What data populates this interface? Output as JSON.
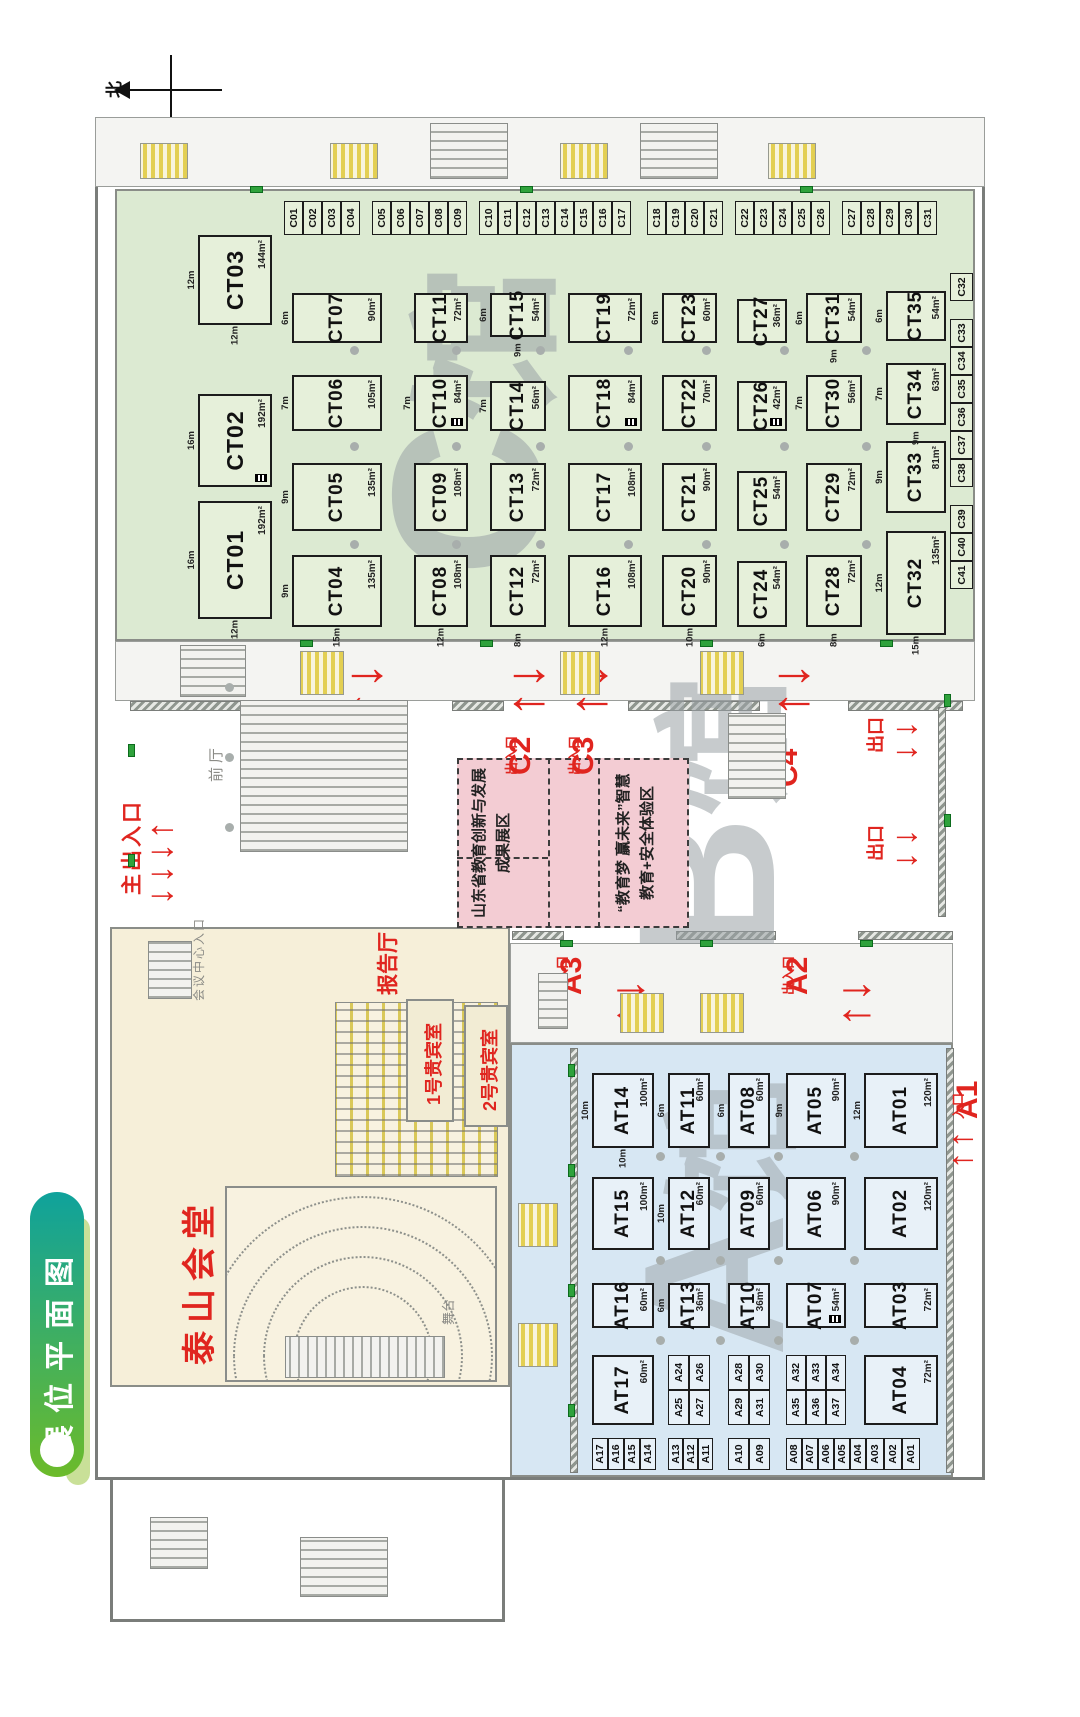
{
  "title": {
    "badge": "展位平面图"
  },
  "compass": {
    "north": "北"
  },
  "watermarks": {
    "c_hall": "C馆",
    "b_hall": "B馆",
    "a_hall": "A馆"
  },
  "entrances": {
    "main": {
      "label": "主出入口"
    },
    "c1": {
      "name": "C1",
      "label": "出入口"
    },
    "c2": {
      "name": "C2",
      "label": "出入口"
    },
    "c3": {
      "name": "C3",
      "label": "出入口"
    },
    "c4": {
      "name": "C4",
      "label": "出入口"
    },
    "a1": {
      "name": "A1",
      "label": "入口"
    },
    "a2": {
      "name": "A2",
      "label": "出入口"
    },
    "a3": {
      "name": "A3",
      "label": "出入口"
    },
    "exit": {
      "label": "出口"
    }
  },
  "zones": {
    "zone1": {
      "line1": "山东省教育创新与发展",
      "line2": "成果展区"
    },
    "zone2": {
      "line1": "“教育梦 赢未来”智慧",
      "line2": "教育+安全体验区"
    }
  },
  "rooms": {
    "taishan": "泰山会堂",
    "lecture": "报告厅",
    "vip1": "1号贵宾室",
    "vip2": "2号贵宾室",
    "front_hall": "前厅",
    "conf_entrance": "会议中心入口",
    "stage": "舞台"
  },
  "c_hall": {
    "top_row": [
      {
        "id": "CT01",
        "area": "192m²",
        "dim_top": "16m",
        "dim_left": "12m"
      },
      {
        "id": "CT02",
        "area": "192m²",
        "dim_top": "16m",
        "icon": true
      },
      {
        "id": "CT03",
        "area": "144m²",
        "dim_top": "12m",
        "dim_left": "12m"
      }
    ],
    "rows": [
      [
        {
          "id": "CT04",
          "area": "135m²",
          "dim_top": "9m",
          "dim_left": "15m"
        },
        {
          "id": "CT05",
          "area": "135m²",
          "dim_top": "9m"
        },
        {
          "id": "CT06",
          "area": "105m²",
          "dim_top": "7m"
        },
        {
          "id": "CT07",
          "area": "90m²",
          "dim_top": "6m"
        }
      ],
      [
        {
          "id": "CT08",
          "area": "108m²",
          "dim_left": "12m"
        },
        {
          "id": "CT09",
          "area": "108m²"
        },
        {
          "id": "CT10",
          "area": "84m²",
          "dim_top": "7m",
          "icon": true
        },
        {
          "id": "CT11",
          "area": "72m²"
        }
      ],
      [
        {
          "id": "CT12",
          "area": "72m²",
          "dim_left": "8m"
        },
        {
          "id": "CT13",
          "area": "72m²"
        },
        {
          "id": "CT14",
          "area": "56m²",
          "dim_top": "7m"
        },
        {
          "id": "CT15",
          "area": "54m²",
          "dim_top": "6m",
          "dim_left": "9m"
        }
      ],
      [
        {
          "id": "CT16",
          "area": "108m²",
          "dim_left": "12m"
        },
        {
          "id": "CT17",
          "area": "108m²"
        },
        {
          "id": "CT18",
          "area": "84m²",
          "icon": true
        },
        {
          "id": "CT19",
          "area": "72m²"
        }
      ],
      [
        {
          "id": "CT20",
          "area": "90m²",
          "dim_left": "10m"
        },
        {
          "id": "CT21",
          "area": "90m²"
        },
        {
          "id": "CT22",
          "area": "70m²"
        },
        {
          "id": "CT23",
          "area": "60m²",
          "dim_top": "6m"
        }
      ],
      [
        {
          "id": "CT24",
          "area": "54m²",
          "dim_left": "6m"
        },
        {
          "id": "CT25",
          "area": "54m²"
        },
        {
          "id": "CT26",
          "area": "42m²",
          "icon": true
        },
        {
          "id": "CT27",
          "area": "36m²"
        }
      ],
      [
        {
          "id": "CT28",
          "area": "72m²",
          "dim_left": "8m"
        },
        {
          "id": "CT29",
          "area": "72m²"
        },
        {
          "id": "CT30",
          "area": "56m²",
          "dim_top": "7m"
        },
        {
          "id": "CT31",
          "area": "54m²",
          "dim_top": "6m",
          "dim_left": "9m"
        }
      ],
      [
        {
          "id": "CT32",
          "area": "135m²",
          "dim_top": "12m",
          "dim_left": "15m"
        },
        {
          "id": "CT33",
          "area": "81m²",
          "dim_top": "9m"
        },
        {
          "id": "CT34",
          "area": "63m²",
          "dim_top": "7m",
          "dim_left": "9m"
        },
        {
          "id": "CT35",
          "area": "54m²",
          "dim_top": "6m"
        }
      ]
    ],
    "side_groups": [
      [
        "C01",
        "C02",
        "C03",
        "C04"
      ],
      [
        "C05",
        "C06",
        "C07",
        "C08",
        "C09"
      ],
      [
        "C10",
        "C11",
        "C12",
        "C13",
        "C14",
        "C15",
        "C16",
        "C17"
      ],
      [
        "C18",
        "C19",
        "C20",
        "C21"
      ],
      [
        "C22",
        "C23",
        "C24",
        "C25",
        "C26"
      ],
      [
        "C27",
        "C28",
        "C29",
        "C30",
        "C31"
      ]
    ],
    "bottom_groups": [
      [
        "C41",
        "C40",
        "C39"
      ],
      [
        "C38",
        "C37",
        "C36",
        "C35",
        "C34",
        "C33"
      ],
      [
        "C32"
      ]
    ]
  },
  "a_hall": {
    "columns": [
      [
        {
          "id": "AT14",
          "area": "100m²",
          "dim_top": "10m",
          "dim_left": "10m"
        },
        {
          "id": "AT11",
          "area": "60m²",
          "dim_top": "6m"
        },
        {
          "id": "AT08",
          "area": "60m²",
          "dim_top": "6m"
        },
        {
          "id": "AT05",
          "area": "90m²",
          "dim_top": "9m"
        },
        {
          "id": "AT01",
          "area": "120m²",
          "dim_top": "12m"
        }
      ],
      [
        {
          "id": "AT15",
          "area": "100m²"
        },
        {
          "id": "AT12",
          "area": "60m²",
          "dim_top": "10m"
        },
        {
          "id": "AT09",
          "area": "60m²"
        },
        {
          "id": "AT06",
          "area": "90m²"
        },
        {
          "id": "AT02",
          "area": "120m²"
        }
      ],
      [
        {
          "id": "AT16",
          "area": "60m²"
        },
        {
          "id": "AT13",
          "area": "36m²",
          "dim_top": "6m"
        },
        {
          "id": "AT10",
          "area": "36m²"
        },
        {
          "id": "AT07",
          "area": "54m²",
          "icon": true
        },
        {
          "id": "AT03",
          "area": "72m²"
        }
      ]
    ],
    "col_d": [
      {
        "id": "AT17",
        "area": "60m²"
      },
      {
        "group": [
          "A25",
          "A24",
          "A27",
          "A26"
        ]
      },
      {
        "group": [
          "A29",
          "A28",
          "A31",
          "A30"
        ]
      },
      {
        "group": [
          "A35",
          "A32",
          "A36",
          "A33",
          "A37",
          "A34"
        ]
      },
      {
        "id": "AT04",
        "area": "72m²"
      }
    ],
    "edge_groups": [
      [
        "A17",
        "A16",
        "A15",
        "A14"
      ],
      [
        "A13",
        "A12",
        "A11"
      ],
      [
        "A10",
        "A09"
      ],
      [
        "A08",
        "A07",
        "A06",
        "A05",
        "A04"
      ],
      [
        "A03",
        "A02",
        "A01"
      ]
    ]
  }
}
